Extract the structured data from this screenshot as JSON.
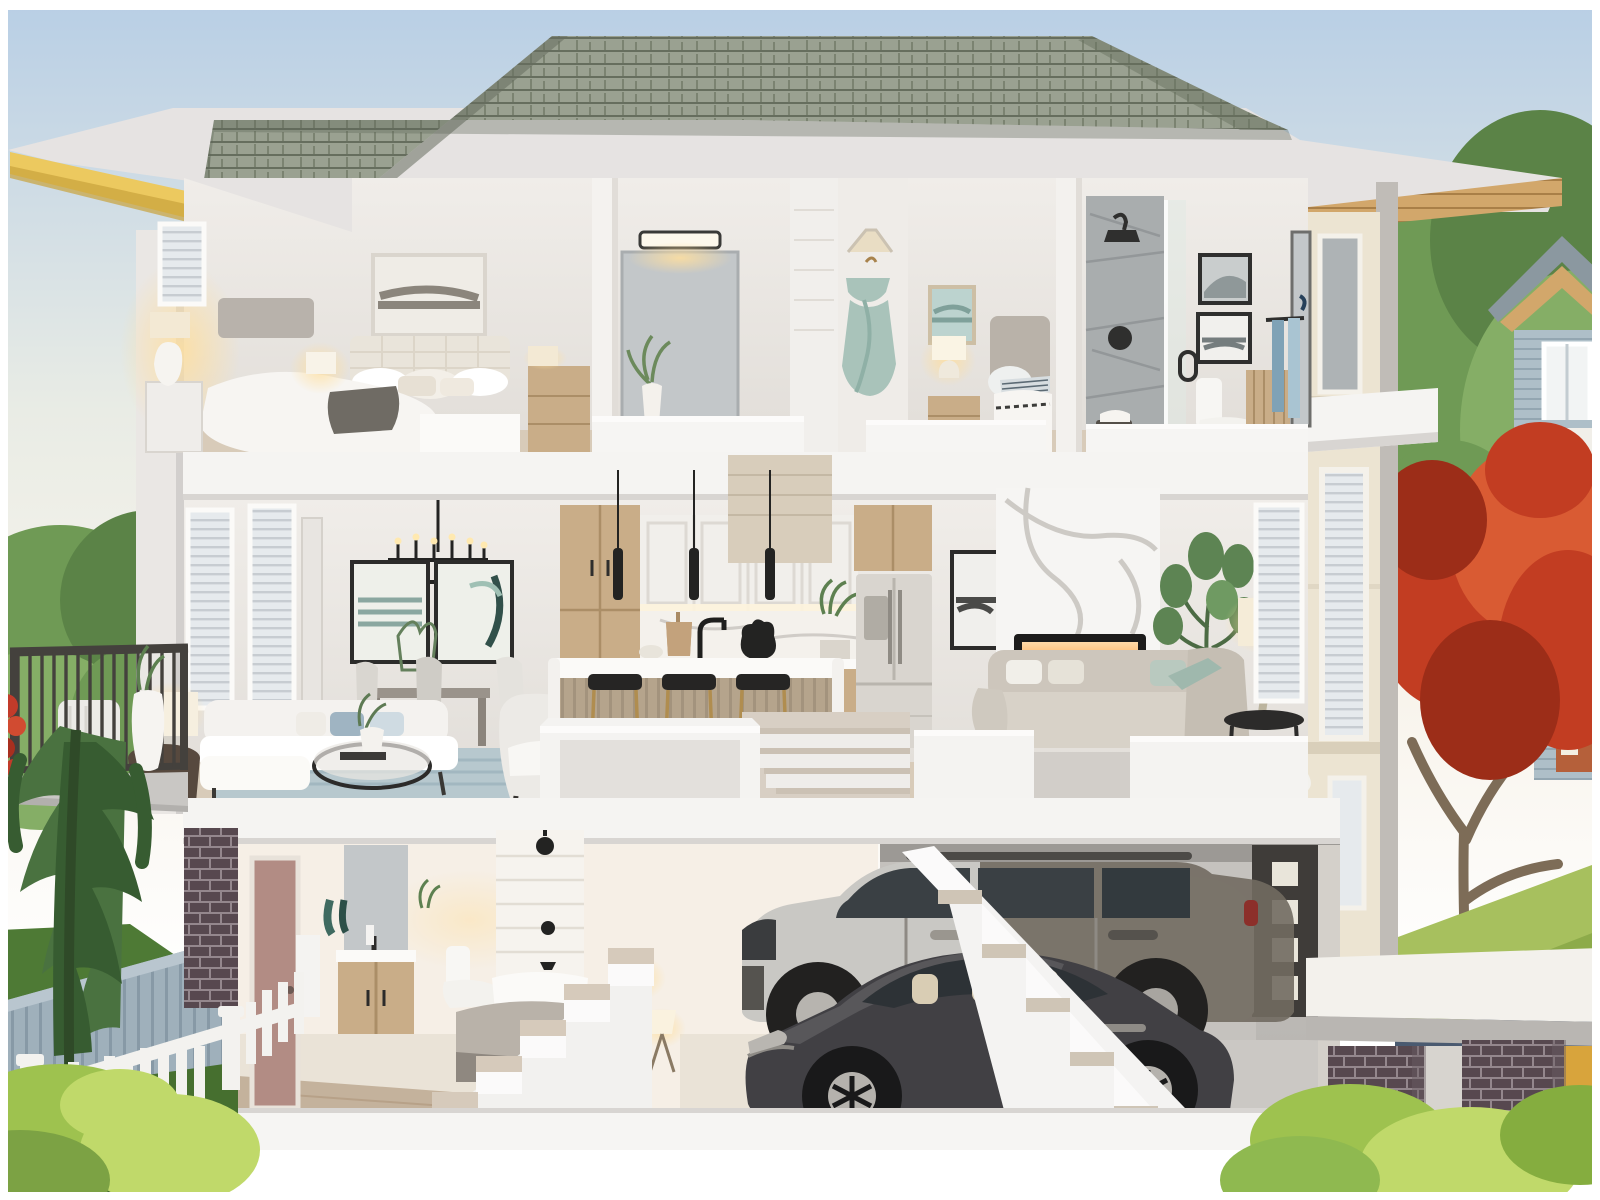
{
  "title": "Three-storey townhouse cutaway rendering",
  "palette": {
    "sky1": "#b9cfe5",
    "sky2": "#e9ece5",
    "sky3": "#f8f4ec",
    "paper": "#ffffff",
    "shingle1": "#9aa191",
    "shingle2": "#7b8371",
    "shingleLine": "#666e5e",
    "fascia": "#e6e3e2",
    "fasciaShade": "#d2cfcd",
    "soffitY1": "#ecc95f",
    "soffitY2": "#c9a23c",
    "soffitWood": "#d2a76b",
    "soffitWoodLine": "#a97f47",
    "wallIn": "#f0ede9",
    "wallShade": "#e1ddd8",
    "wallWarm": "#f6efe6",
    "slab": "#f5f4f2",
    "slabEdge": "#d8d5d2",
    "colL": "#eae7e4",
    "wallCream": "#ece4d2",
    "wallCreamShade": "#d9cfba",
    "wallGray": "#c0bcb7",
    "floorWood": "#d8cbb9",
    "floorWood2": "#c4b29c",
    "floorTile": "#eae3d7",
    "rugBlue": "#b7c8ce",
    "rugBlueLine": "#9db4bd",
    "rugGray": "#d2cec9",
    "sofaWhite": "#f4f2ef",
    "sofaGreige": "#cdc6bc",
    "pillowSage": "#b9c9bf",
    "pillowBlue": "#9fb4c2",
    "woodCab": "#c9ad88",
    "woodCabDark": "#ab8e67",
    "islandWood": "#b5a48c",
    "black": "#2e2d2c",
    "metalDark": "#4a4845",
    "marbleVein": "#c7c3be",
    "fireOrange": "#ff9d3a",
    "fireGlow": "#ffd9a8",
    "fridge": "#d9d5cf",
    "mirror": "#c3c7c9",
    "mirrorDark": "#aeb3b5",
    "windowGlass": "#e6eaed",
    "blindLine": "#c7ccd1",
    "tileShower": "#a9adae",
    "tileVein": "#8e9294",
    "towelBlue": "#7fa2b6",
    "dress": "#a9c3ba",
    "bedWhite": "#f7f5f2",
    "bedGray": "#b9b2a9",
    "headboard": "#e9e4da",
    "throwGray": "#6f6b64",
    "lampShade": "#f3e9d4",
    "glow": "#ffdf9e",
    "doorMauve": "#b28c84",
    "brickD": "#57484f",
    "brickDM": "#94878d",
    "brickL": "#c0a29a",
    "brickLM": "#e2d4ce",
    "conifer1": "#4a7240",
    "conifer2": "#375c31",
    "tree1": "#6f9a55",
    "tree2": "#85ae66",
    "tree3": "#5b8347",
    "maple1": "#c23d22",
    "maple2": "#d95b33",
    "maple3": "#9c2d18",
    "trunk": "#7d6c57",
    "lawn1": "#a7c05e",
    "lawn2": "#7b9c3e",
    "lawnD1": "#4e7a35",
    "lawnD2": "#3f6629",
    "bush1": "#9ec24f",
    "bush2": "#c0d96a",
    "fenceWhite": "#f3f2ef",
    "fenceGray": "#9fb0bb",
    "fenceGrayD": "#8799a6",
    "drive": "#4a5a70",
    "driveCurb": "#cdd5d0",
    "suvSilver": "#c9c8c4",
    "suvDark": "#716a60",
    "glassC": "#3a4044",
    "sedan": "#414044",
    "sedanHi": "#6b6a6e",
    "seatCream": "#d9cdb4",
    "neighborBlue": "#aebfc8",
    "neighborWood": "#c8a478",
    "neighborRoof": "#8b98a0",
    "doorOrange": "#b5603a",
    "railDark": "#44413d",
    "garage1": "#b6b3af",
    "garage2": "#c5c2be",
    "garageFloor": "#cbc8c4",
    "garageDoor": "#3f3c39",
    "garageWin": "#e9e5da"
  },
  "scene": {
    "building": {
      "label": "townhouse cross-section",
      "storeys": 3
    },
    "roof": {
      "label": "hip roof with grey shingles",
      "objects": [
        "shingles",
        "white fascia cut",
        "yellow eave soffit",
        "wood eave soffit"
      ]
    },
    "upper_floor": {
      "label": "upper floor",
      "rooms": [
        {
          "name": "master bedroom",
          "objects": [
            "window with blinds",
            "abstract art frame",
            "tufted bed",
            "nightstand",
            "table lamps",
            "dresser"
          ]
        },
        {
          "name": "vanity nook",
          "objects": [
            "mirror",
            "vanity light bar",
            "wood vanity cabinet",
            "plant vase"
          ]
        },
        {
          "name": "closet column",
          "objects": [
            "sage dress on hanger",
            "basket"
          ]
        },
        {
          "name": "second bedroom",
          "objects": [
            "landscape art",
            "glowing lamp",
            "grey headboard bed",
            "dresser"
          ]
        },
        {
          "name": "bathroom",
          "objects": [
            "marble tile shower",
            "glass door",
            "black shower head",
            "toilet",
            "two framed photos",
            "wood cabinet",
            "blue towels",
            "tall mirror"
          ]
        }
      ]
    },
    "main_floor": {
      "label": "main floor",
      "rooms": [
        {
          "name": "living dining",
          "objects": [
            "two tall windows",
            "black candle chandelier",
            "two abstract art frames",
            "dining table with chairs",
            "white sectional sofa",
            "blue rug",
            "round coffee table",
            "drum side table with lamp",
            "armchair"
          ]
        },
        {
          "name": "kitchen",
          "objects": [
            "tall wood cabinets",
            "white upper cabinets",
            "three black pendants",
            "marble backsplash",
            "island with wood base",
            "three brass stools",
            "french-door fridge",
            "kettle",
            "plant"
          ]
        },
        {
          "name": "family room",
          "objects": [
            "marble fireplace wall",
            "linear gas fireplace",
            "greige sofa",
            "fiddle leaf plant",
            "table lamp",
            "side table",
            "windows with blinds",
            "powder toilet"
          ]
        }
      ]
    },
    "lower_floor": {
      "label": "lower floor",
      "rooms": [
        {
          "name": "bathroom hall",
          "objects": [
            "mauve door",
            "wood vanity with mirror",
            "toilet",
            "tub with black fixtures"
          ]
        },
        {
          "name": "bedroom",
          "objects": [
            "grey bed",
            "tripod lamps"
          ]
        },
        {
          "name": "garage",
          "objects": [
            "silver SUV",
            "dark grey sedan",
            "garage door with lit windows",
            "cut-away staircase"
          ]
        }
      ]
    },
    "stairs": {
      "label": "staircases",
      "objects": [
        "main-to-lower stairs",
        "lower-left stairs",
        "diagonal garage stairs"
      ]
    },
    "exterior_left": {
      "label": "left yard",
      "objects": [
        "balcony with dark railing",
        "white chair",
        "white planter vase",
        "red flowers",
        "green trees",
        "weeping conifer",
        "dark lawn",
        "grey plank fence",
        "white picket fence",
        "bright bushes",
        "dark brick corner"
      ]
    },
    "exterior_right": {
      "label": "right yard",
      "objects": [
        "cream side wall with windows",
        "red maple tree",
        "green trees",
        "neighbour gable house",
        "neighbour house with orange door",
        "lawn",
        "driveway",
        "white entry canopy",
        "two-tone brick pillars",
        "bushes",
        "yellow brace"
      ]
    }
  }
}
